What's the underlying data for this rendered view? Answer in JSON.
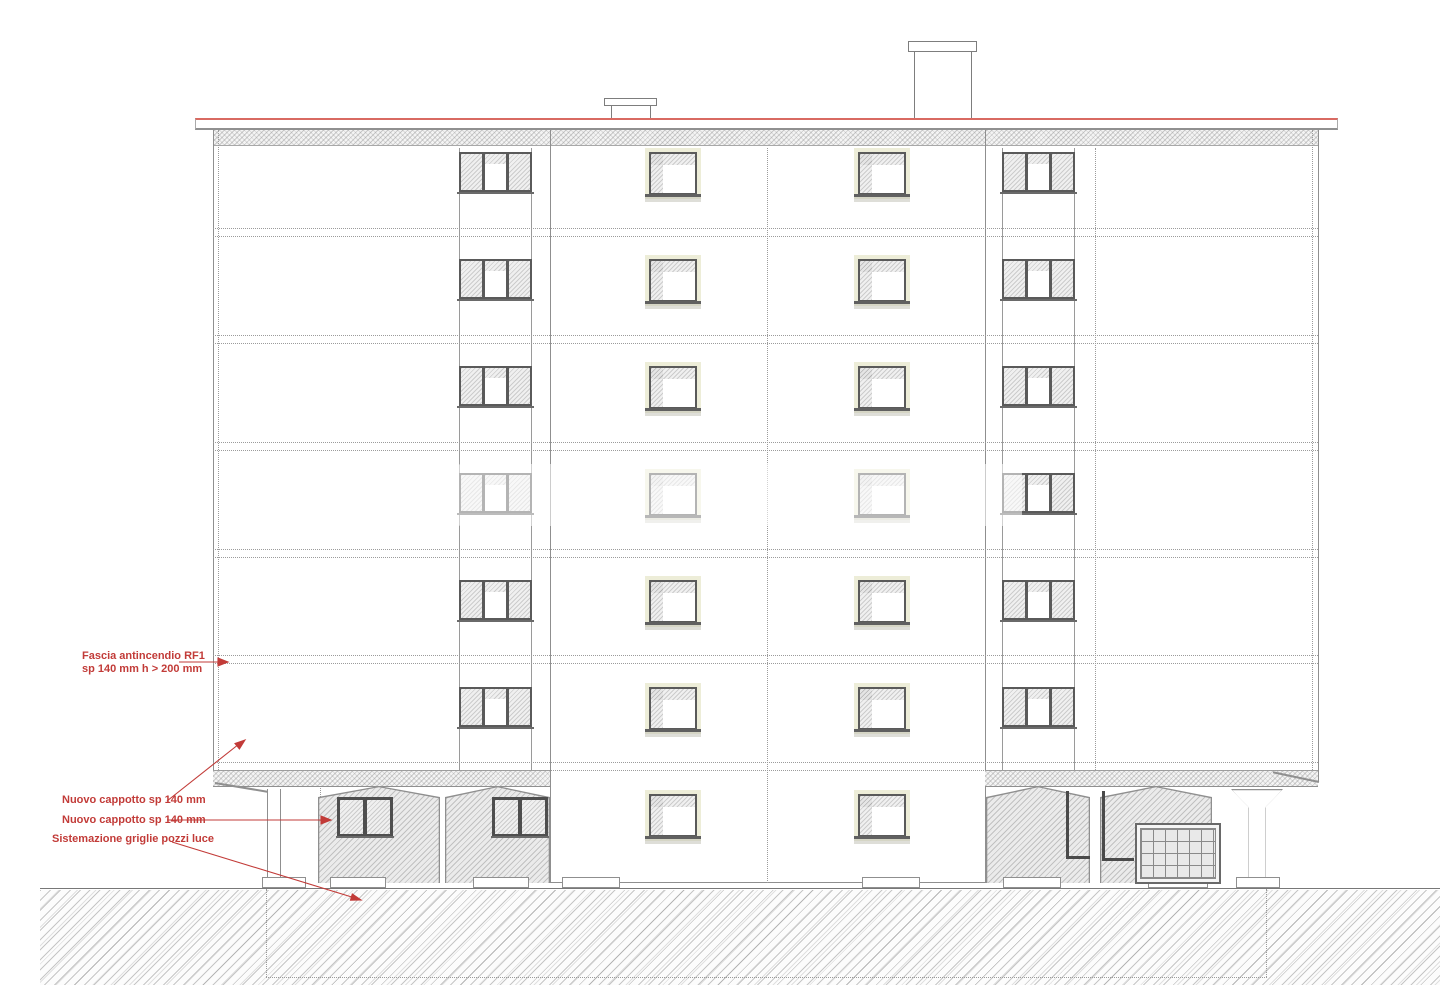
{
  "drawing": {
    "type": "building-elevation",
    "annotations": {
      "fascia": {
        "line1": "Fascia antincendio RF1",
        "line2": "sp 140 mm h > 200 mm"
      },
      "cappotto_upper": {
        "line1": "Nuovo cappotto sp 140 mm"
      },
      "cappotto_lower": {
        "line1": "Nuovo cappotto sp 140 mm"
      },
      "griglie": {
        "line1": "Sistemazione griglie pozzi luce"
      }
    },
    "colors": {
      "annotation_red": "#c23b38",
      "roof_red": "#d96a62",
      "line_gray": "#8f8f8f",
      "frame_dark": "#5a5a5a",
      "window_glow": "#ededd8"
    },
    "figure": {
      "window_rows_y": [
        152,
        259,
        366,
        473,
        580,
        687,
        794
      ],
      "floor_line_pairs_y": [
        228,
        335,
        442,
        549,
        655,
        762
      ],
      "triple_window_cols_x": [
        459,
        1002
      ],
      "single_window_cols_x": [
        649,
        858
      ],
      "triple_rows": 6,
      "ground_windows": [
        {
          "x": 337,
          "y": 797
        },
        {
          "x": 492,
          "y": 797
        }
      ],
      "base_strips": [
        [
          262,
          44
        ],
        [
          330,
          56
        ],
        [
          473,
          56
        ],
        [
          562,
          58
        ],
        [
          862,
          58
        ],
        [
          1003,
          58
        ],
        [
          1148,
          60
        ],
        [
          1236,
          44
        ]
      ]
    }
  }
}
